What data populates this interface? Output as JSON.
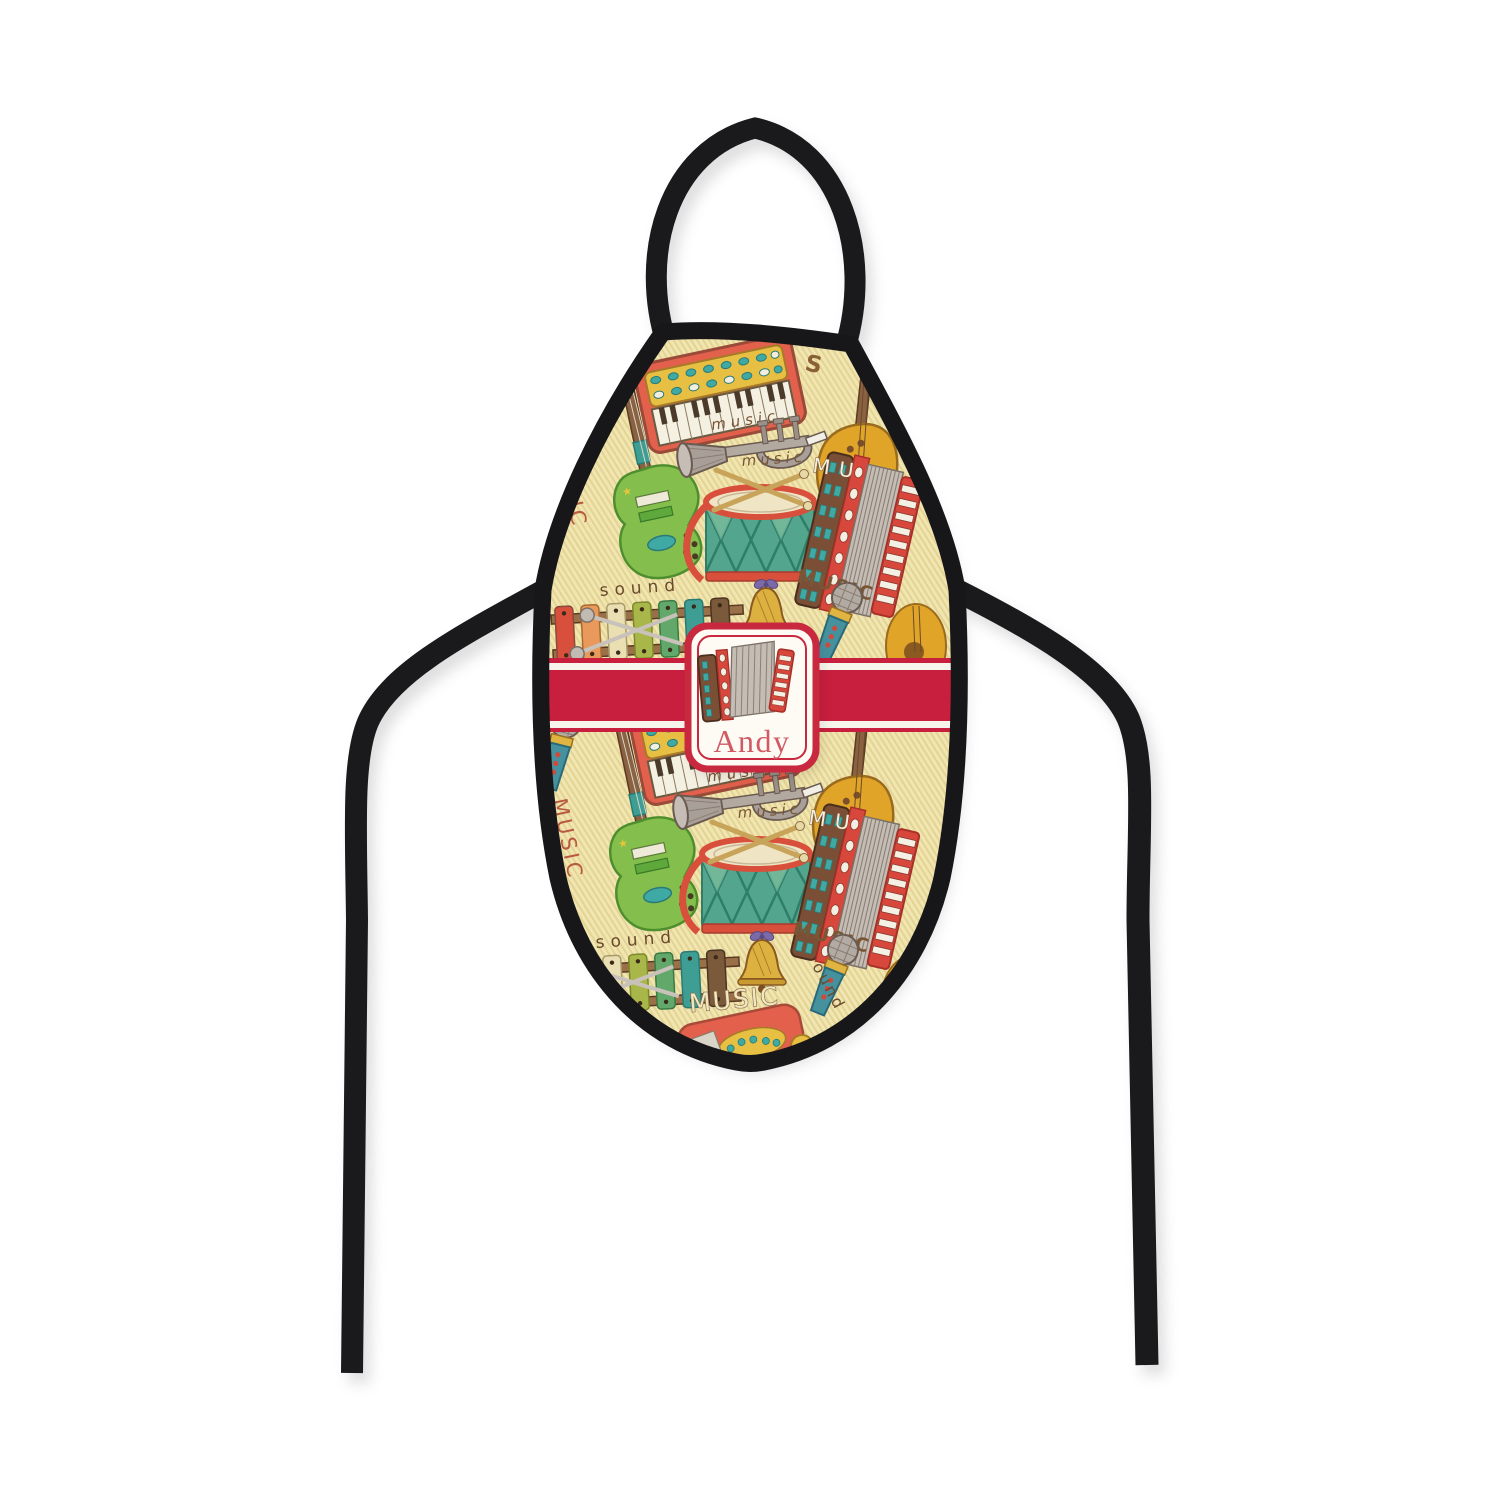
{
  "product": {
    "kind": "personalized bottle apron product photo",
    "name_plate": {
      "name": "Andy",
      "name_color": "#d15a64",
      "border_color": "#c8293f",
      "background": "#fdfbf4",
      "center_icon": "accordion-icon"
    },
    "ribbon": {
      "color": "#c81f3e",
      "stripe_color": "#f7f4ec"
    },
    "apron": {
      "base_color": "#f0e5ae",
      "stripe_color": "#e3d494",
      "binding_color": "#17171a"
    },
    "pattern": {
      "words": {
        "music_cursive": "music",
        "music_caps": "MUSIC",
        "music_outline": "MUSIC",
        "music_vertical": "MUSIC",
        "sound": "sound",
        "sound_partial": "ound",
        "mu_partial": "MU",
        "s_partial": "S",
        "star": "★",
        "heart": "♥"
      },
      "icons": [
        "melodica-keyboard-icon",
        "trumpet-icon",
        "snare-drum-icon",
        "drumsticks-icon",
        "accordion-icon",
        "electric-guitar-icon",
        "acoustic-guitar-icon",
        "xylophone-icon",
        "mallets-icon",
        "handbell-icon",
        "microphone-icon",
        "toy-piano-icon"
      ]
    }
  }
}
